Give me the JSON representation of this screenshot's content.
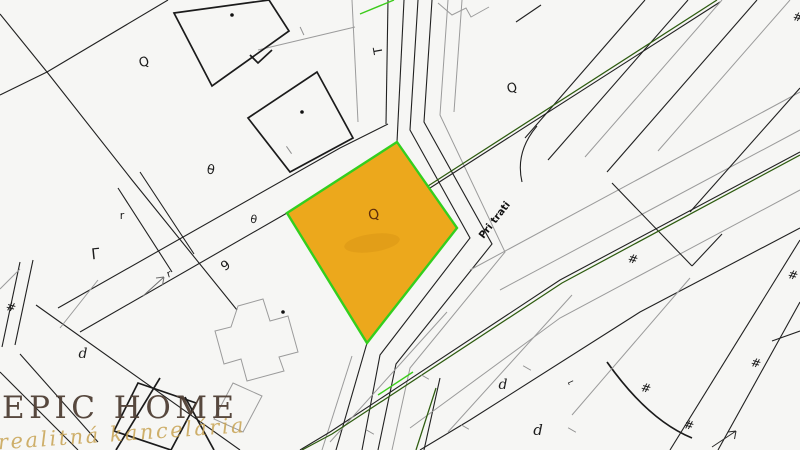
{
  "map": {
    "street_label": "Pri trati",
    "background_color": "#f6f6f4",
    "line_color": "#212121",
    "secondary_line_color": "#9b9b9b",
    "road_edge_green": "#2e5c10",
    "boundary_green": "#3ccb1b",
    "highlight": {
      "name": "highlighted-parcel",
      "fill": "#eca81c",
      "stroke": "#33cf1e",
      "stroke_width": 2.4,
      "symbol": "Q"
    },
    "symbols": [
      {
        "g": "Q",
        "x": 145,
        "y": 66,
        "r": -15,
        "s": 13
      },
      {
        "g": "Q",
        "x": 375,
        "y": 219,
        "r": -15,
        "s": 14,
        "c": "#5f2e0c"
      },
      {
        "g": "Q",
        "x": 513,
        "y": 92,
        "r": -15,
        "s": 13
      },
      {
        "g": "T",
        "x": 382,
        "y": 50,
        "r": -100,
        "s": 12
      },
      {
        "g": "θ",
        "x": 210,
        "y": 174,
        "r": 10,
        "s": 13
      },
      {
        "g": "θ",
        "x": 253,
        "y": 223,
        "r": 10,
        "s": 11
      },
      {
        "g": "r",
        "x": 122,
        "y": 219,
        "r": 0,
        "s": 11
      },
      {
        "g": "r",
        "x": 170,
        "y": 277,
        "r": -18,
        "s": 10
      },
      {
        "g": "Γ",
        "x": 96,
        "y": 259,
        "r": -6,
        "s": 15
      },
      {
        "g": "9",
        "x": 228,
        "y": 269,
        "r": -35,
        "s": 13
      },
      {
        "g": "d",
        "x": 83,
        "y": 358,
        "r": 0,
        "s": 14,
        "i": 1
      },
      {
        "g": "d",
        "x": 503,
        "y": 389,
        "r": 0,
        "s": 14,
        "i": 1
      },
      {
        "g": "d",
        "x": 538,
        "y": 435,
        "r": 0,
        "s": 15,
        "i": 1
      },
      {
        "g": "#",
        "x": 10,
        "y": 311,
        "r": 14,
        "s": 12,
        "i": 1
      },
      {
        "g": "#",
        "x": 797,
        "y": 21,
        "r": 14,
        "s": 12,
        "i": 1
      },
      {
        "g": "#",
        "x": 632,
        "y": 263,
        "r": 14,
        "s": 12,
        "i": 1
      },
      {
        "g": "#",
        "x": 792,
        "y": 279,
        "r": 14,
        "s": 12,
        "i": 1
      },
      {
        "g": "#",
        "x": 755,
        "y": 367,
        "r": 14,
        "s": 12,
        "i": 1
      },
      {
        "g": "#",
        "x": 645,
        "y": 392,
        "r": 14,
        "s": 12,
        "i": 1
      },
      {
        "g": "#",
        "x": 688,
        "y": 429,
        "r": 14,
        "s": 12,
        "i": 1
      },
      {
        "g": "⌐",
        "x": 572,
        "y": 385,
        "r": -25,
        "s": 9
      }
    ],
    "building_dots": [
      [
        232,
        15
      ],
      [
        302,
        112
      ],
      [
        283,
        312
      ]
    ],
    "ticks": [
      [
        302,
        31,
        65
      ],
      [
        425,
        377,
        30
      ],
      [
        527,
        368,
        30
      ],
      [
        572,
        430,
        30
      ],
      [
        370,
        432,
        30
      ],
      [
        465,
        427,
        30
      ],
      [
        289,
        150,
        55
      ]
    ]
  },
  "watermark": {
    "title": "EPIC HOME",
    "subtitle": "realitná kancelária",
    "title_color": "#4f3f35",
    "subtitle_color": "#c8a353"
  }
}
